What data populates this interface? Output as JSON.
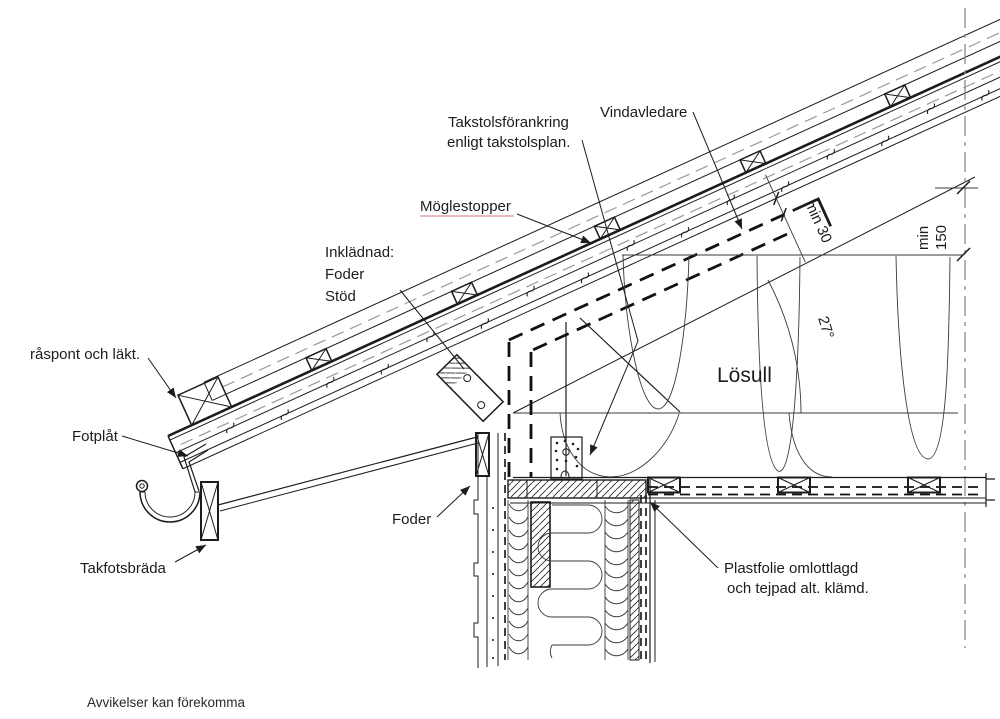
{
  "drawing": {
    "labels": {
      "takstolsforankring": {
        "line1": "Takstolsförankring",
        "line2": "enligt takstolsplan."
      },
      "vindavledare": "Vindavledare",
      "moglestopper": "Möglestopper",
      "inkladnad": {
        "line1": "Inklädnad:",
        "line2": "Foder",
        "line3": "Stöd"
      },
      "raspont": "råspont och läkt.",
      "fotplat": "Fotplåt",
      "takfotsbrada": "Takfotsbräda",
      "foder": "Foder",
      "losull": "Lösull",
      "plastfolie": {
        "line1": "Plastfolie omlottlagd",
        "line2": "och tejpad alt. klämd."
      }
    },
    "dimensions": {
      "min150": {
        "line1": "min",
        "line2": "150"
      },
      "min30": "min 30",
      "roof_angle": "27°"
    },
    "footnote": "Avvikelser kan förekomma",
    "colors": {
      "line": "#1c1c1c",
      "grey_dash": "#9a9a9a",
      "spellcheck_underline": "#df8f8f",
      "background": "#ffffff"
    }
  }
}
